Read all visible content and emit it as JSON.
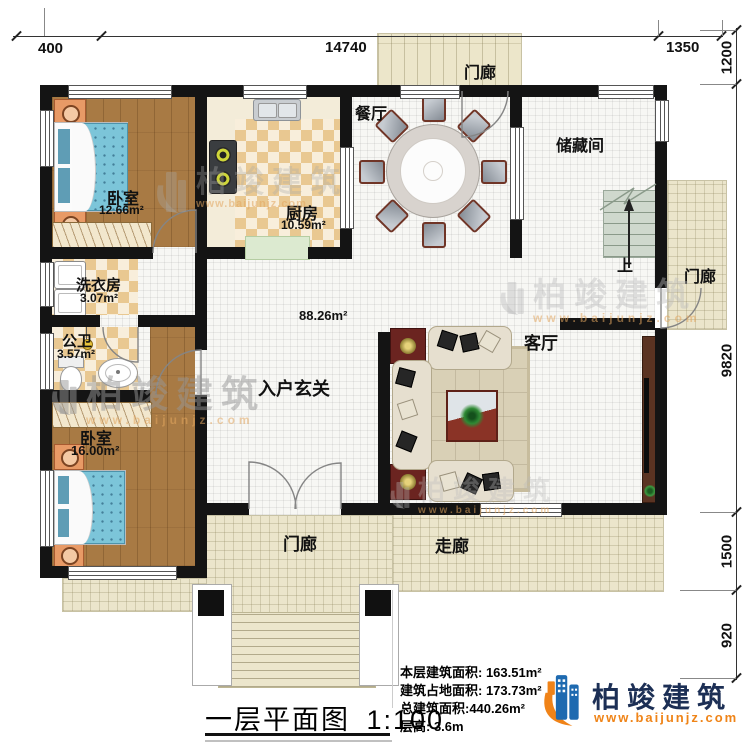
{
  "plan": {
    "rooms": {
      "bedroom1": {
        "name": "卧室",
        "area": "12.66m²"
      },
      "kitchen": {
        "name": "厨房",
        "area": "10.59m²"
      },
      "dining": {
        "name": "餐厅"
      },
      "storage": {
        "name": "储藏间"
      },
      "laundry": {
        "name": "洗衣房",
        "area": "3.07m²"
      },
      "bathroom": {
        "name": "公卫",
        "area": "3.57m²"
      },
      "bedroom2": {
        "name": "卧室",
        "area": "16.00m²"
      },
      "foyer": {
        "name": "入户玄关",
        "area": "88.26m²"
      },
      "living": {
        "name": "客厅"
      },
      "porch_top": {
        "name": "门廊"
      },
      "porch_right": {
        "name": "门廊"
      },
      "porch_bottom": {
        "name": "门廊"
      },
      "corridor": {
        "name": "走廊"
      }
    },
    "stairs": {
      "up_label": "上"
    }
  },
  "dimensions": {
    "top": [
      {
        "label": "400"
      },
      {
        "label": "14740"
      },
      {
        "label": "1350"
      }
    ],
    "right": [
      {
        "label": "1200"
      },
      {
        "label": "9820"
      },
      {
        "label": "1500"
      },
      {
        "label": "920"
      }
    ]
  },
  "footer": {
    "drawing_title": "一层平面图",
    "drawing_scale": "1:100",
    "stats": [
      {
        "label": "本层建筑面积: 163.51m²"
      },
      {
        "label": "建筑占地面积: 173.73m²"
      },
      {
        "label": "总建筑面积:440.26m²"
      },
      {
        "label": "层高: 3.6m"
      }
    ]
  },
  "brand": {
    "name": "柏竣建筑",
    "website": "www.baijunjz.com"
  },
  "watermark": {
    "text": "柏竣建筑",
    "website": "www.baijunjz.com"
  },
  "colors": {
    "wall": "#141414",
    "brand_blue": "#1e6ab0",
    "brand_orange": "#f08318",
    "brand_navy": "#1c2f55",
    "wood_floor": "#a87a44",
    "checker_tile": "#e9c891",
    "porch_tile": "#ebe5cb",
    "bed_blue": "#7cc5d9"
  }
}
